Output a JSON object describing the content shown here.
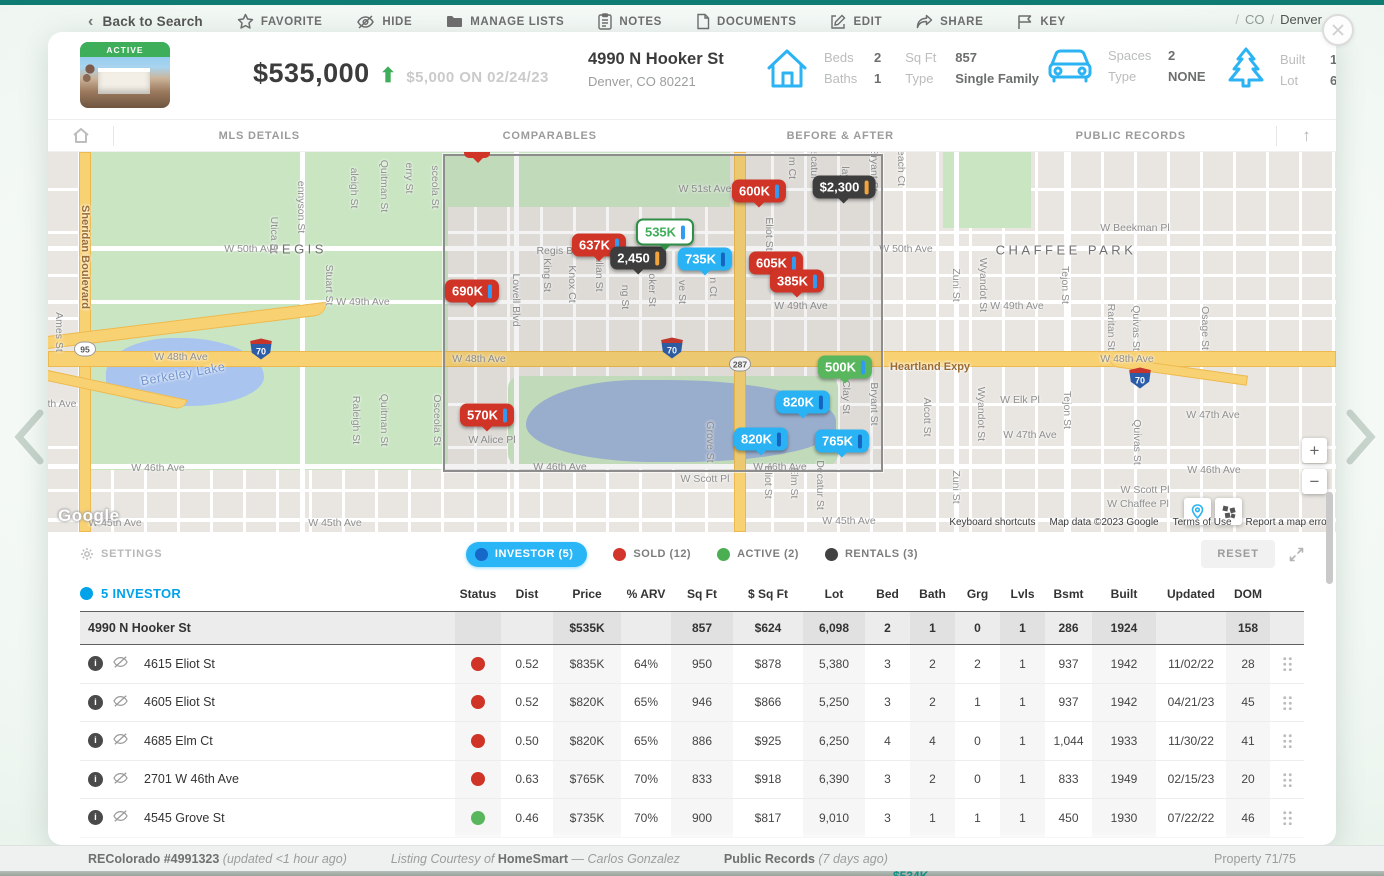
{
  "chrome": {
    "back": "Back to Search",
    "actions": [
      {
        "icon": "star-icon",
        "label": "FAVORITE"
      },
      {
        "icon": "eye-off-icon",
        "label": "HIDE"
      },
      {
        "icon": "folder-icon",
        "label": "MANAGE LISTS"
      },
      {
        "icon": "notes-icon",
        "label": "NOTES"
      },
      {
        "icon": "document-icon",
        "label": "DOCUMENTS"
      },
      {
        "icon": "edit-icon",
        "label": "EDIT"
      },
      {
        "icon": "share-icon",
        "label": "SHARE"
      },
      {
        "icon": "flag-icon",
        "label": "KEY"
      }
    ],
    "breadcrumb": {
      "state": "CO",
      "city": "Denver"
    }
  },
  "header": {
    "status_badge": "ACTIVE",
    "price": "$535,000",
    "price_arrow": "up",
    "price_change": "$5,000 ON 02/24/23",
    "address": "4990 N Hooker St",
    "city_line": "Denver, CO 80221",
    "beds_label": "Beds",
    "beds": "2",
    "baths_label": "Baths",
    "baths": "1",
    "sqft_label": "Sq Ft",
    "sqft": "857",
    "type_label": "Type",
    "type": "Single Family",
    "spaces_label": "Spaces",
    "spaces": "2",
    "gtype_label": "Type",
    "gtype": "NONE",
    "built_label": "Built",
    "built": "1924",
    "lot_label": "Lot",
    "lot": "6,098"
  },
  "tabs": [
    "MLS DETAILS",
    "COMPARABLES",
    "BEFORE & AFTER",
    "PUBLIC RECORDS"
  ],
  "map": {
    "labels": [
      {
        "t": "W 51st Ave",
        "x": 657,
        "y": 37,
        "k": "st"
      },
      {
        "t": "W 50th Ave",
        "x": 203,
        "y": 97,
        "k": "st"
      },
      {
        "t": "REGIS",
        "x": 250,
        "y": 97,
        "k": "nbhd"
      },
      {
        "t": "Regis Bl",
        "x": 508,
        "y": 99,
        "k": "st"
      },
      {
        "t": "W 50th Ave",
        "x": 858,
        "y": 97,
        "k": "st"
      },
      {
        "t": "CHAFFEE PARK",
        "x": 1018,
        "y": 98,
        "k": "nbhd"
      },
      {
        "t": "W Beekman Pl",
        "x": 1087,
        "y": 76,
        "k": "st"
      },
      {
        "t": "W 49th Ave",
        "x": 315,
        "y": 150,
        "k": "st"
      },
      {
        "t": "W 49th Ave",
        "x": 753,
        "y": 154,
        "k": "st"
      },
      {
        "t": "W 49th Ave",
        "x": 969,
        "y": 154,
        "k": "st"
      },
      {
        "t": "W 48th Ave",
        "x": 133,
        "y": 205,
        "k": "st"
      },
      {
        "t": "W 48th Ave",
        "x": 431,
        "y": 207,
        "k": "st"
      },
      {
        "t": "W 48th Ave",
        "x": 1079,
        "y": 207,
        "k": "st"
      },
      {
        "t": "Heartland Expy",
        "x": 882,
        "y": 215,
        "k": "hwy"
      },
      {
        "t": "W Elk Pl",
        "x": 972,
        "y": 248,
        "k": "st"
      },
      {
        "t": "th Ave",
        "x": 14,
        "y": 252,
        "k": "st"
      },
      {
        "t": "W 47th Ave",
        "x": 982,
        "y": 283,
        "k": "st"
      },
      {
        "t": "W 47th Ave",
        "x": 1165,
        "y": 263,
        "k": "st"
      },
      {
        "t": "W Alice Pl",
        "x": 444,
        "y": 288,
        "k": "st"
      },
      {
        "t": "W 46th Ave",
        "x": 110,
        "y": 316,
        "k": "st"
      },
      {
        "t": "W 46th Ave",
        "x": 512,
        "y": 315,
        "k": "st"
      },
      {
        "t": "W 46th Ave",
        "x": 732,
        "y": 315,
        "k": "st"
      },
      {
        "t": "W 46th Ave",
        "x": 1166,
        "y": 318,
        "k": "st"
      },
      {
        "t": "W Scott Pl",
        "x": 657,
        "y": 327,
        "k": "st"
      },
      {
        "t": "W Scott Pl",
        "x": 1097,
        "y": 338,
        "k": "st"
      },
      {
        "t": "W Chaffee Pl",
        "x": 1090,
        "y": 352,
        "k": "st"
      },
      {
        "t": "W 45th Ave",
        "x": 67,
        "y": 371,
        "k": "st"
      },
      {
        "t": "W 45th Ave",
        "x": 287,
        "y": 371,
        "k": "st"
      },
      {
        "t": "W 45th Ave",
        "x": 801,
        "y": 369,
        "k": "st"
      },
      {
        "t": "Berkeley Lake",
        "x": 135,
        "y": 222,
        "k": "lake"
      },
      {
        "t": "Sheridan Boulevard",
        "x": 37,
        "y": 105,
        "k": "stv hwy"
      },
      {
        "t": "Ames St",
        "x": 11,
        "y": 180,
        "k": "stv"
      },
      {
        "t": "Utica St",
        "x": 226,
        "y": 83,
        "k": "stv"
      },
      {
        "t": "ennyson St",
        "x": 253,
        "y": 55,
        "k": "stv"
      },
      {
        "t": "Stuart St",
        "x": 281,
        "y": 133,
        "k": "stv"
      },
      {
        "t": "aleigh St",
        "x": 306,
        "y": 36,
        "k": "stv"
      },
      {
        "t": "Raleigh St",
        "x": 308,
        "y": 268,
        "k": "stv"
      },
      {
        "t": "Quitman St",
        "x": 336,
        "y": 34,
        "k": "stv"
      },
      {
        "t": "Quitman St",
        "x": 336,
        "y": 268,
        "k": "stv"
      },
      {
        "t": "erry St",
        "x": 361,
        "y": 26,
        "k": "stv"
      },
      {
        "t": "sceola St",
        "x": 387,
        "y": 35,
        "k": "stv"
      },
      {
        "t": "Osceola St",
        "x": 389,
        "y": 268,
        "k": "stv"
      },
      {
        "t": "Lowell Blvd",
        "x": 468,
        "y": 148,
        "k": "stv"
      },
      {
        "t": "King St",
        "x": 499,
        "y": 123,
        "k": "stv"
      },
      {
        "t": "Knox Ct",
        "x": 524,
        "y": 132,
        "k": "stv"
      },
      {
        "t": "ulian St",
        "x": 551,
        "y": 122,
        "k": "stv"
      },
      {
        "t": "ng St",
        "x": 577,
        "y": 145,
        "k": "stv"
      },
      {
        "t": "oker St",
        "x": 604,
        "y": 138,
        "k": "stv"
      },
      {
        "t": "ve St",
        "x": 634,
        "y": 140,
        "k": "stv"
      },
      {
        "t": "n Ct",
        "x": 665,
        "y": 135,
        "k": "stv"
      },
      {
        "t": "Grove St",
        "x": 662,
        "y": 290,
        "k": "stv"
      },
      {
        "t": "Eliot St",
        "x": 721,
        "y": 82,
        "k": "stv"
      },
      {
        "t": "m Ct",
        "x": 744,
        "y": 16,
        "k": "stv"
      },
      {
        "t": "ecatur",
        "x": 766,
        "y": 13,
        "k": "stv"
      },
      {
        "t": "Eliot St",
        "x": 720,
        "y": 330,
        "k": "stv"
      },
      {
        "t": "Elm St",
        "x": 746,
        "y": 331,
        "k": "stv"
      },
      {
        "t": "Decatur St",
        "x": 772,
        "y": 333,
        "k": "stv"
      },
      {
        "t": "Clay St",
        "x": 798,
        "y": 245,
        "k": "stv"
      },
      {
        "t": "lay S",
        "x": 797,
        "y": 26,
        "k": "stv"
      },
      {
        "t": "Bryant St",
        "x": 826,
        "y": 18,
        "k": "stv"
      },
      {
        "t": "Bryant St",
        "x": 826,
        "y": 252,
        "k": "stv"
      },
      {
        "t": "each Ct",
        "x": 853,
        "y": 16,
        "k": "stv"
      },
      {
        "t": "Zuni St",
        "x": 908,
        "y": 133,
        "k": "stv"
      },
      {
        "t": "Zuni St",
        "x": 908,
        "y": 335,
        "k": "stv"
      },
      {
        "t": "Wyandot St",
        "x": 935,
        "y": 133,
        "k": "stv"
      },
      {
        "t": "Wyandot St",
        "x": 933,
        "y": 262,
        "k": "stv"
      },
      {
        "t": "Alcott St",
        "x": 879,
        "y": 265,
        "k": "stv"
      },
      {
        "t": "Tejon St",
        "x": 1017,
        "y": 133,
        "k": "stv"
      },
      {
        "t": "Tejon St",
        "x": 1019,
        "y": 258,
        "k": "stv"
      },
      {
        "t": "Raritan St",
        "x": 1063,
        "y": 175,
        "k": "stv"
      },
      {
        "t": "Quivas St",
        "x": 1088,
        "y": 176,
        "k": "stv"
      },
      {
        "t": "Quivas St",
        "x": 1089,
        "y": 290,
        "k": "stv"
      },
      {
        "t": "Osage St",
        "x": 1157,
        "y": 176,
        "k": "stv"
      }
    ],
    "shields": [
      {
        "t": "95",
        "k": "us",
        "x": 37,
        "y": 197
      },
      {
        "t": "70",
        "k": "i70",
        "x": 213,
        "y": 197
      },
      {
        "t": "70",
        "k": "i70",
        "x": 624,
        "y": 196
      },
      {
        "t": "287",
        "k": "us",
        "x": 692,
        "y": 212
      },
      {
        "t": "70",
        "k": "i70",
        "x": 1092,
        "y": 226
      }
    ],
    "markers": [
      {
        "t": "600K",
        "type": "sold",
        "x": 711,
        "y": 39
      },
      {
        "t": "$2,300",
        "type": "rental",
        "x": 796,
        "y": 35
      },
      {
        "t": "637K",
        "type": "sold",
        "x": 551,
        "y": 93
      },
      {
        "t": "2,450",
        "type": "rental",
        "x": 590,
        "y": 106
      },
      {
        "t": "535K",
        "type": "subject",
        "x": 617,
        "y": 80
      },
      {
        "t": "735K",
        "type": "investor",
        "x": 657,
        "y": 107
      },
      {
        "t": "605K",
        "type": "sold",
        "x": 728,
        "y": 111
      },
      {
        "t": "385K",
        "type": "sold",
        "x": 749,
        "y": 129
      },
      {
        "t": "690K",
        "type": "sold",
        "x": 424,
        "y": 139
      },
      {
        "t": "500K",
        "type": "active",
        "x": 797,
        "y": 215
      },
      {
        "t": "820K",
        "type": "investor",
        "x": 755,
        "y": 250
      },
      {
        "t": "570K",
        "type": "sold",
        "x": 439,
        "y": 263
      },
      {
        "t": "820K",
        "type": "investor",
        "x": 713,
        "y": 287
      },
      {
        "t": "765K",
        "type": "investor",
        "x": 794,
        "y": 289
      }
    ],
    "controls": {
      "zoom_in": "+",
      "zoom_out": "−"
    },
    "google": "Google",
    "attribution": [
      "Keyboard shortcuts",
      "Map data ©2023 Google",
      "Terms of Use",
      "Report a map error"
    ]
  },
  "legend": {
    "settings": "SETTINGS",
    "items": [
      {
        "label": "INVESTOR",
        "count": "(5)",
        "active": true
      },
      {
        "label": "SOLD",
        "count": "(12)",
        "color": "#d2352b"
      },
      {
        "label": "ACTIVE",
        "count": "(2)",
        "color": "#4cae52"
      },
      {
        "label": "RENTALS",
        "count": "(3)",
        "color": "#424242"
      }
    ],
    "reset": "RESET"
  },
  "table": {
    "title": "5 INVESTOR",
    "columns": [
      "Status",
      "Dist",
      "Price",
      "% ARV",
      "Sq Ft",
      "$ Sq Ft",
      "Lot",
      "Bed",
      "Bath",
      "Grg",
      "Lvls",
      "Bsmt",
      "Built",
      "Updated",
      "DOM"
    ],
    "subject": {
      "address": "4990 N Hooker St",
      "status": "",
      "dist": "",
      "price": "$535K",
      "arv": "",
      "sqft": "857",
      "psqft": "$624",
      "lot": "6,098",
      "bed": "2",
      "bath": "1",
      "grg": "0",
      "lvls": "1",
      "bsmt": "286",
      "built": "1924",
      "updated": "",
      "dom": "158"
    },
    "rows": [
      {
        "address": "4615 Eliot St",
        "status": "sold",
        "dist": "0.52",
        "price": "$835K",
        "arv": "64%",
        "sqft": "950",
        "psqft": "$878",
        "lot": "5,380",
        "bed": "3",
        "bath": "2",
        "grg": "2",
        "lvls": "1",
        "bsmt": "937",
        "built": "1942",
        "updated": "11/02/22",
        "dom": "28"
      },
      {
        "address": "4605 Eliot St",
        "status": "sold",
        "dist": "0.52",
        "price": "$820K",
        "arv": "65%",
        "sqft": "946",
        "psqft": "$866",
        "lot": "5,250",
        "bed": "3",
        "bath": "2",
        "grg": "1",
        "lvls": "1",
        "bsmt": "937",
        "built": "1942",
        "updated": "04/21/23",
        "dom": "45"
      },
      {
        "address": "4685 Elm Ct",
        "status": "sold",
        "dist": "0.50",
        "price": "$820K",
        "arv": "65%",
        "sqft": "886",
        "psqft": "$925",
        "lot": "6,250",
        "bed": "4",
        "bath": "4",
        "grg": "0",
        "lvls": "1",
        "bsmt": "1,044",
        "built": "1933",
        "updated": "11/30/22",
        "dom": "41"
      },
      {
        "address": "2701 W 46th Ave",
        "status": "sold",
        "dist": "0.63",
        "price": "$765K",
        "arv": "70%",
        "sqft": "833",
        "psqft": "$918",
        "lot": "6,390",
        "bed": "3",
        "bath": "2",
        "grg": "0",
        "lvls": "1",
        "bsmt": "833",
        "built": "1949",
        "updated": "02/15/23",
        "dom": "20"
      },
      {
        "address": "4545 Grove St",
        "status": "active",
        "dist": "0.46",
        "price": "$735K",
        "arv": "70%",
        "sqft": "900",
        "psqft": "$817",
        "lot": "9,010",
        "bed": "3",
        "bath": "1",
        "grg": "1",
        "lvls": "1",
        "bsmt": "450",
        "built": "1930",
        "updated": "07/22/22",
        "dom": "46"
      }
    ]
  },
  "footer": {
    "mls": "REColorado #4991323",
    "mls_updated": "(updated <1 hour ago)",
    "courtesy_prefix": "Listing Courtesy of",
    "courtesy_broker": "HomeSmart",
    "courtesy_agent": "— Carlos Gonzalez",
    "public_records": "Public Records",
    "public_records_age": "(7 days ago)",
    "pager": "Property 71/75",
    "peek": "$534K"
  },
  "colors": {
    "sold": "#cf3427",
    "investor": "#29b2f4",
    "active": "#58b65c",
    "rental": "#3d3d3d",
    "subject_border": "#2f8f46",
    "subject_text": "#3fae5a",
    "bar_blue": "#2f9bf3",
    "bar_dark_blue": "#1464c0",
    "bar_orange": "#f2a33c",
    "accent_blue": "#29b5f6",
    "brand_teal": "#0e7c73"
  }
}
